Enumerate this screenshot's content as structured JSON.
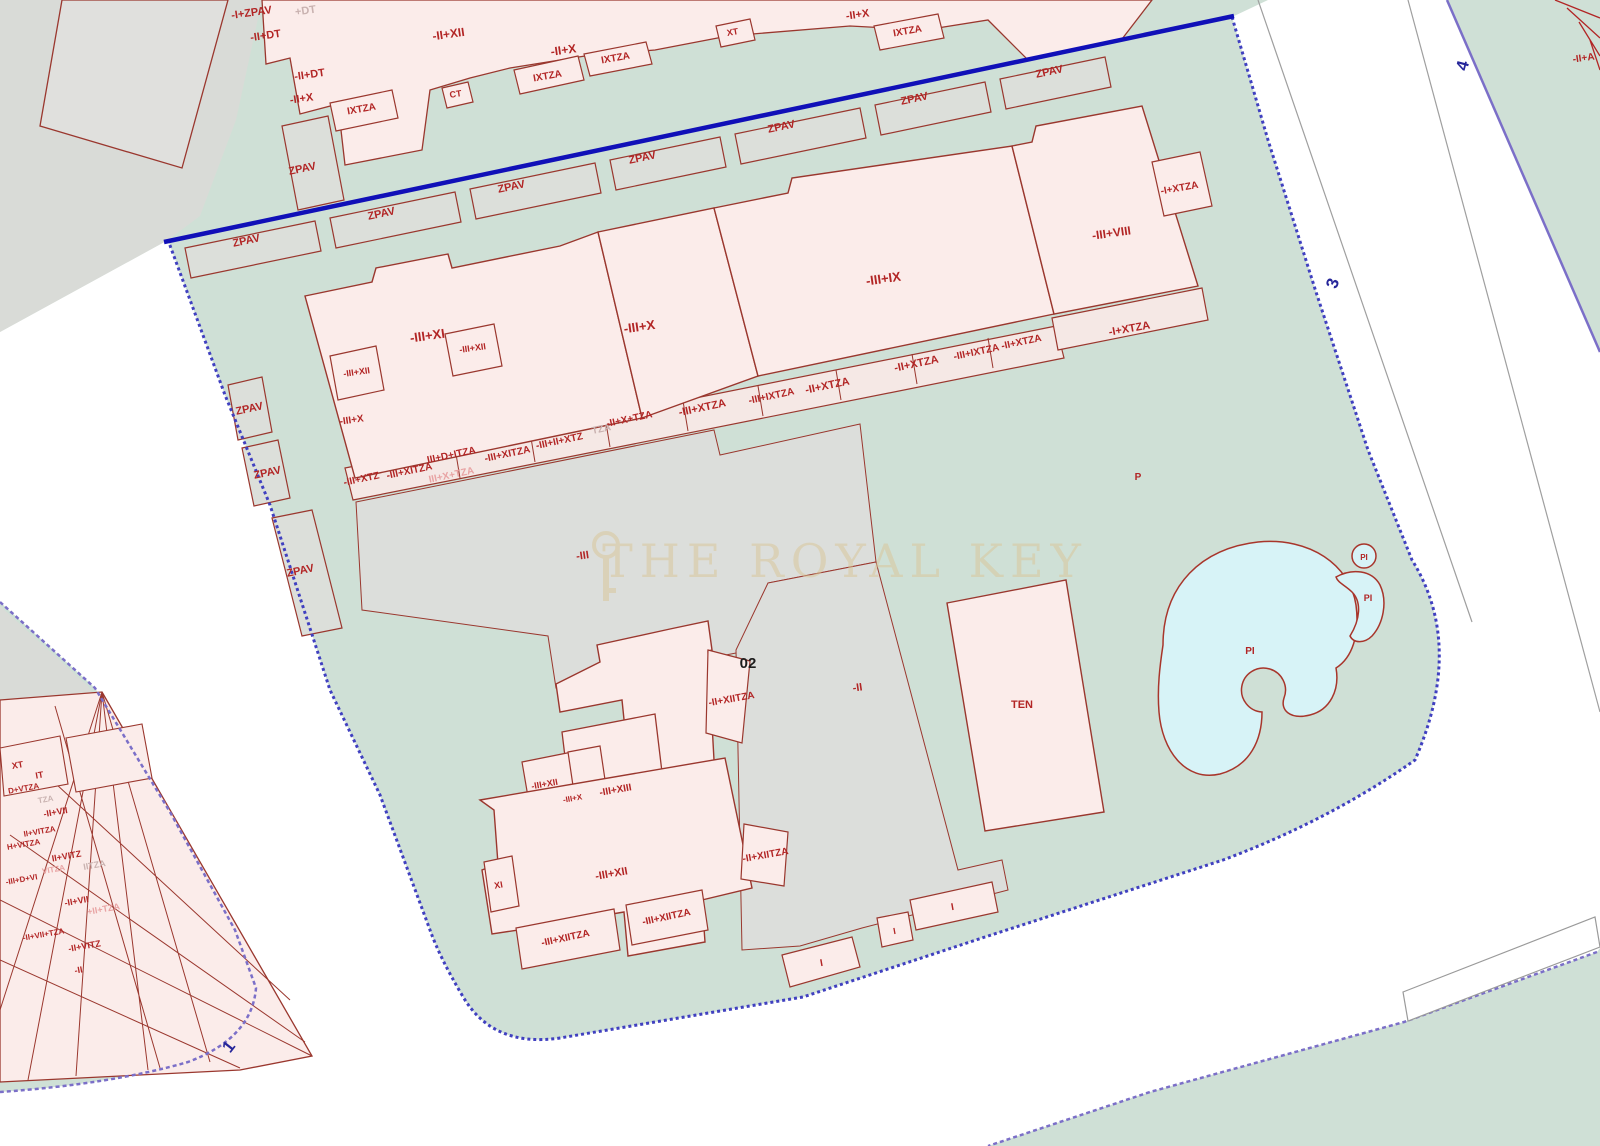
{
  "map": {
    "watermark": {
      "text": "THE ROYAL KEY"
    },
    "palette": {
      "parcel_green": "#cfe0d6",
      "parcel_gray": "#dcdedb",
      "building_pink": "#fbecea",
      "building_outline": "#9a372e",
      "label_red": "#b22525",
      "label_gray": "#c9b2b0",
      "label_pink": "#e8a3a3",
      "street_number_blue": "#26269a",
      "boundary_blue": "#1010b8",
      "boundary_dotted": "#4040c0",
      "boundary_purple": "#7b6fc8",
      "pool_cyan": "#d7f3f7"
    },
    "labels": [
      {
        "t": "-I+ZPAV",
        "x": 252,
        "y": 16,
        "s": 11,
        "c": "#b22525",
        "r": -8
      },
      {
        "t": "+DT",
        "x": 306,
        "y": 14,
        "s": 11,
        "c": "#c9b2b0",
        "r": -8
      },
      {
        "t": "-II+DT",
        "x": 266,
        "y": 39,
        "s": 11,
        "c": "#b22525",
        "r": -8
      },
      {
        "t": "-II+DT",
        "x": 310,
        "y": 78,
        "s": 11,
        "c": "#b22525",
        "r": -8
      },
      {
        "t": "-II+X",
        "x": 302,
        "y": 102,
        "s": 11,
        "c": "#b22525",
        "r": -8
      },
      {
        "t": "IXTZA",
        "x": 362,
        "y": 112,
        "s": 10,
        "c": "#b22525",
        "r": -10
      },
      {
        "t": "-II+XII",
        "x": 449,
        "y": 38,
        "s": 12,
        "c": "#b22525",
        "r": -8
      },
      {
        "t": "CT",
        "x": 456,
        "y": 97,
        "s": 9,
        "c": "#b22525",
        "r": -8
      },
      {
        "t": "-II+X",
        "x": 564,
        "y": 54,
        "s": 12,
        "c": "#b22525",
        "r": -8
      },
      {
        "t": "IXTZA",
        "x": 548,
        "y": 79,
        "s": 10,
        "c": "#b22525",
        "r": -10
      },
      {
        "t": "IXTZA",
        "x": 616,
        "y": 61,
        "s": 10,
        "c": "#b22525",
        "r": -10
      },
      {
        "t": "XT",
        "x": 733,
        "y": 35,
        "s": 9,
        "c": "#b22525",
        "r": -10
      },
      {
        "t": "-II+X",
        "x": 858,
        "y": 18,
        "s": 11,
        "c": "#b22525",
        "r": -8
      },
      {
        "t": "IXTZA",
        "x": 908,
        "y": 34,
        "s": 10,
        "c": "#b22525",
        "r": -10
      },
      {
        "t": "ZPAV",
        "x": 247,
        "y": 244,
        "s": 11,
        "c": "#b22525",
        "r": -12
      },
      {
        "t": "ZPAV",
        "x": 303,
        "y": 172,
        "s": 11,
        "c": "#b22525",
        "r": -12
      },
      {
        "t": "ZPAV",
        "x": 382,
        "y": 217,
        "s": 11,
        "c": "#b22525",
        "r": -12
      },
      {
        "t": "ZPAV",
        "x": 512,
        "y": 190,
        "s": 11,
        "c": "#b22525",
        "r": -12
      },
      {
        "t": "ZPAV",
        "x": 643,
        "y": 161,
        "s": 11,
        "c": "#b22525",
        "r": -12
      },
      {
        "t": "ZPAV",
        "x": 782,
        "y": 130,
        "s": 11,
        "c": "#b22525",
        "r": -12
      },
      {
        "t": "ZPAV",
        "x": 915,
        "y": 102,
        "s": 11,
        "c": "#b22525",
        "r": -12
      },
      {
        "t": "ZPAV",
        "x": 1050,
        "y": 75,
        "s": 11,
        "c": "#b22525",
        "r": -12
      },
      {
        "t": "ZPAV",
        "x": 250,
        "y": 412,
        "s": 11,
        "c": "#b22525",
        "r": -12
      },
      {
        "t": "ZPAV",
        "x": 268,
        "y": 476,
        "s": 11,
        "c": "#b22525",
        "r": -12
      },
      {
        "t": "ZPAV",
        "x": 301,
        "y": 574,
        "s": 11,
        "c": "#b22525",
        "r": -12
      },
      {
        "t": "-III+XI",
        "x": 428,
        "y": 340,
        "s": 13,
        "c": "#b22525",
        "r": -8
      },
      {
        "t": "-III+XII",
        "x": 473,
        "y": 351,
        "s": 9,
        "c": "#b22525",
        "r": -8
      },
      {
        "t": "-III+XII",
        "x": 357,
        "y": 375,
        "s": 9,
        "c": "#b22525",
        "r": -8
      },
      {
        "t": "-III+X",
        "x": 352,
        "y": 423,
        "s": 10,
        "c": "#b22525",
        "r": -8
      },
      {
        "t": "-III+X",
        "x": 640,
        "y": 331,
        "s": 13,
        "c": "#b22525",
        "r": -8
      },
      {
        "t": "-III+IX",
        "x": 884,
        "y": 283,
        "s": 13,
        "c": "#b22525",
        "r": -8
      },
      {
        "t": "-III+VIII",
        "x": 1112,
        "y": 237,
        "s": 12,
        "c": "#b22525",
        "r": -8
      },
      {
        "t": "-I+XTZA",
        "x": 1180,
        "y": 191,
        "s": 10,
        "c": "#b22525",
        "r": -10
      },
      {
        "t": "-I+XTZA",
        "x": 1130,
        "y": 332,
        "s": 11,
        "c": "#b22525",
        "r": -10
      },
      {
        "t": "-III+XTZ",
        "x": 362,
        "y": 482,
        "s": 10,
        "c": "#b22525",
        "r": -12
      },
      {
        "t": "-III+XITZA",
        "x": 410,
        "y": 474,
        "s": 10,
        "c": "#b22525",
        "r": -12
      },
      {
        "t": "III+X+TZA",
        "x": 452,
        "y": 478,
        "s": 10,
        "c": "#e8a3a3",
        "r": -12
      },
      {
        "t": "III+D+ITZA",
        "x": 452,
        "y": 458,
        "s": 10,
        "c": "#b22525",
        "r": -12
      },
      {
        "t": "-III+XITZA",
        "x": 508,
        "y": 457,
        "s": 10,
        "c": "#b22525",
        "r": -12
      },
      {
        "t": "-III+II+XTZ",
        "x": 560,
        "y": 444,
        "s": 10,
        "c": "#b22525",
        "r": -12
      },
      {
        "t": "TZA",
        "x": 602,
        "y": 432,
        "s": 10,
        "c": "#c9b2b0",
        "r": -12
      },
      {
        "t": "-II+X+TZA",
        "x": 630,
        "y": 422,
        "s": 10,
        "c": "#b22525",
        "r": -12
      },
      {
        "t": "-III+XTZA",
        "x": 703,
        "y": 411,
        "s": 11,
        "c": "#b22525",
        "r": -12
      },
      {
        "t": "-III+IXTZA",
        "x": 772,
        "y": 399,
        "s": 10,
        "c": "#b22525",
        "r": -12
      },
      {
        "t": "-II+XTZA",
        "x": 828,
        "y": 389,
        "s": 11,
        "c": "#b22525",
        "r": -12
      },
      {
        "t": "-II+XTZA",
        "x": 917,
        "y": 367,
        "s": 11,
        "c": "#b22525",
        "r": -12
      },
      {
        "t": "-III+IXTZA",
        "x": 977,
        "y": 355,
        "s": 10,
        "c": "#b22525",
        "r": -12
      },
      {
        "t": "-II+XTZA",
        "x": 1022,
        "y": 345,
        "s": 10,
        "c": "#b22525",
        "r": -12
      },
      {
        "t": "-III",
        "x": 583,
        "y": 559,
        "s": 11,
        "c": "#b22525",
        "r": -8
      },
      {
        "t": "02",
        "x": 748,
        "y": 668,
        "s": 15,
        "c": "#1d1d1d",
        "r": 0
      },
      {
        "t": "-II",
        "x": 858,
        "y": 691,
        "s": 11,
        "c": "#b22525",
        "r": -8
      },
      {
        "t": "P",
        "x": 1138,
        "y": 480,
        "s": 10,
        "c": "#b22525",
        "r": 0,
        "b": 1
      },
      {
        "t": "-II+XIITZA",
        "x": 732,
        "y": 702,
        "s": 10,
        "c": "#b22525",
        "r": -10
      },
      {
        "t": "-III+XII",
        "x": 545,
        "y": 787,
        "s": 9,
        "c": "#b22525",
        "r": -10
      },
      {
        "t": "-III+X",
        "x": 573,
        "y": 801,
        "s": 8,
        "c": "#b22525",
        "r": -10
      },
      {
        "t": "-III+XIII",
        "x": 616,
        "y": 793,
        "s": 10,
        "c": "#b22525",
        "r": -10
      },
      {
        "t": "-III+XII",
        "x": 612,
        "y": 877,
        "s": 11,
        "c": "#b22525",
        "r": -10
      },
      {
        "t": "XI",
        "x": 499,
        "y": 888,
        "s": 9,
        "c": "#b22525",
        "r": -10
      },
      {
        "t": "-II+XIITZA",
        "x": 766,
        "y": 858,
        "s": 10,
        "c": "#b22525",
        "r": -10
      },
      {
        "t": "-III+XIITZA",
        "x": 667,
        "y": 920,
        "s": 10,
        "c": "#b22525",
        "r": -12
      },
      {
        "t": "-III+XIITZA",
        "x": 566,
        "y": 941,
        "s": 10,
        "c": "#b22525",
        "r": -12
      },
      {
        "t": "TEN",
        "x": 1022,
        "y": 708,
        "s": 11,
        "c": "#b22525",
        "r": 0,
        "b": 1
      },
      {
        "t": "PI",
        "x": 1250,
        "y": 654,
        "s": 10,
        "c": "#b22525",
        "r": 0,
        "b": 1
      },
      {
        "t": "PI",
        "x": 1364,
        "y": 560,
        "s": 8,
        "c": "#b22525",
        "r": 0,
        "b": 1
      },
      {
        "t": "PI",
        "x": 1368,
        "y": 601,
        "s": 9,
        "c": "#b22525",
        "r": 0,
        "b": 1
      },
      {
        "t": "I",
        "x": 822,
        "y": 966,
        "s": 10,
        "c": "#b22525",
        "r": -10
      },
      {
        "t": "I",
        "x": 895,
        "y": 934,
        "s": 9,
        "c": "#b22525",
        "r": -10
      },
      {
        "t": "I",
        "x": 953,
        "y": 910,
        "s": 10,
        "c": "#b22525",
        "r": -10
      },
      {
        "t": "XT",
        "x": 18,
        "y": 768,
        "s": 9,
        "c": "#b22525",
        "r": -10
      },
      {
        "t": "IT",
        "x": 40,
        "y": 778,
        "s": 9,
        "c": "#b22525",
        "r": -10
      },
      {
        "t": "D+VTZA",
        "x": 24,
        "y": 791,
        "s": 8,
        "c": "#b22525",
        "r": -10
      },
      {
        "t": "TZA",
        "x": 46,
        "y": 802,
        "s": 8,
        "c": "#c9b2b0",
        "r": -10
      },
      {
        "t": "-II+VII",
        "x": 56,
        "y": 815,
        "s": 9,
        "c": "#b22525",
        "r": -10
      },
      {
        "t": "II+VITZA",
        "x": 40,
        "y": 834,
        "s": 8,
        "c": "#b22525",
        "r": -10
      },
      {
        "t": "H+VITZA",
        "x": 24,
        "y": 847,
        "s": 8,
        "c": "#b22525",
        "r": -10
      },
      {
        "t": "II+VITZ",
        "x": 67,
        "y": 859,
        "s": 9,
        "c": "#b22525",
        "r": -10
      },
      {
        "t": "IITZA",
        "x": 95,
        "y": 868,
        "s": 9,
        "c": "#c9b2b0",
        "r": -10
      },
      {
        "t": "VITZA",
        "x": 54,
        "y": 872,
        "s": 8,
        "c": "#e8a3a3",
        "r": -10
      },
      {
        "t": "-III+D+VI",
        "x": 22,
        "y": 882,
        "s": 8,
        "c": "#b22525",
        "r": -10
      },
      {
        "t": "-II+VII",
        "x": 77,
        "y": 904,
        "s": 9,
        "c": "#b22525",
        "r": -10
      },
      {
        "t": "+II+TZA",
        "x": 104,
        "y": 912,
        "s": 9,
        "c": "#e8a3a3",
        "r": -10
      },
      {
        "t": "-II+VII+TZA",
        "x": 44,
        "y": 937,
        "s": 8,
        "c": "#b22525",
        "r": -10
      },
      {
        "t": "-II+VITZ",
        "x": 85,
        "y": 949,
        "s": 9,
        "c": "#b22525",
        "r": -10
      },
      {
        "t": "-II",
        "x": 79,
        "y": 973,
        "s": 9,
        "c": "#b22525",
        "r": -10
      },
      {
        "t": "1",
        "x": 233,
        "y": 1050,
        "s": 17,
        "c": "#26269a",
        "r": -52,
        "b": 1
      },
      {
        "t": "3",
        "x": 1338,
        "y": 285,
        "s": 17,
        "c": "#26269a",
        "r": -72,
        "b": 1
      },
      {
        "t": "4",
        "x": 1468,
        "y": 67,
        "s": 17,
        "c": "#26269a",
        "r": -75,
        "b": 1
      },
      {
        "t": "-II+A",
        "x": 1584,
        "y": 61,
        "s": 10,
        "c": "#b22525",
        "r": -8
      }
    ]
  }
}
